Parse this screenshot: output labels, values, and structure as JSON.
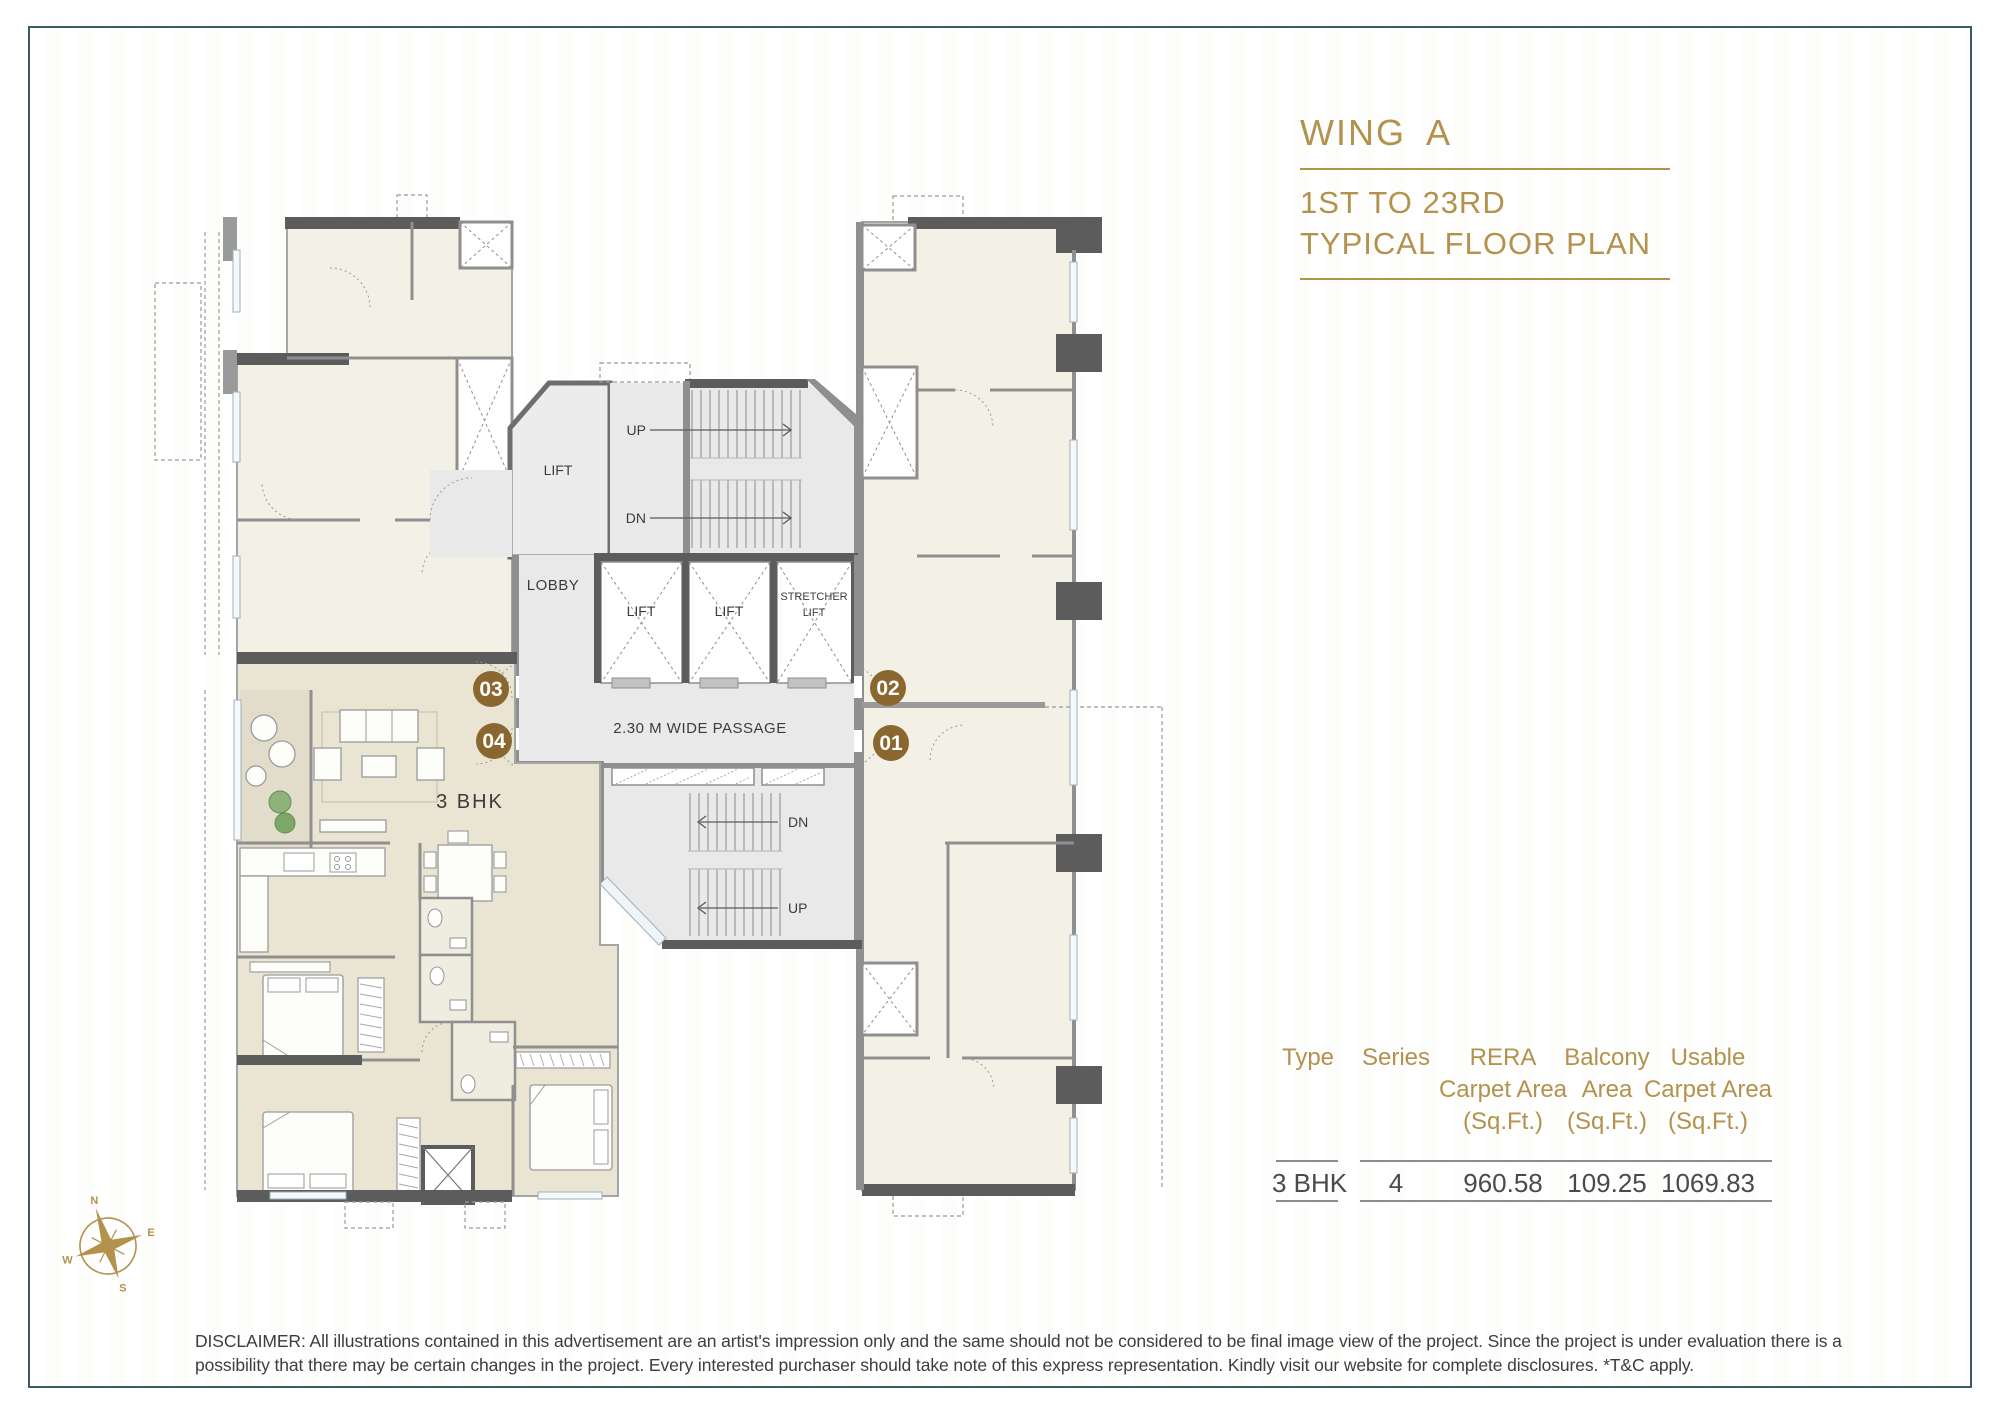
{
  "page": {
    "border_color": "#3e5a66",
    "accent_color": "#b2924d"
  },
  "header": {
    "wing_title": "WING A",
    "floor_line1": "1ST TO 23RD",
    "floor_line2": "TYPICAL FLOOR PLAN"
  },
  "floor_plan": {
    "labels": {
      "lift_room": "LIFT",
      "lobby": "LOBBY",
      "up_top": "UP",
      "dn_top": "DN",
      "lift_1": "LIFT",
      "lift_2": "LIFT",
      "stretcher_line1": "STRETCHER",
      "stretcher_line2": "LIFT",
      "passage": "2.30 M WIDE PASSAGE",
      "unit_type": "3 BHK",
      "dn_bottom": "DN",
      "up_bottom": "UP"
    },
    "unit_markers": [
      {
        "number": "03"
      },
      {
        "number": "04"
      },
      {
        "number": "02"
      },
      {
        "number": "01"
      }
    ],
    "marker_color": "#8a672f"
  },
  "compass": {
    "north": "N",
    "east": "E",
    "south": "S",
    "west": "W"
  },
  "area_table": {
    "columns": [
      {
        "line1": "Type",
        "line2": "",
        "line3": ""
      },
      {
        "line1": "Series",
        "line2": "",
        "line3": ""
      },
      {
        "line1": "RERA",
        "line2": "Carpet Area",
        "line3": "(Sq.Ft.)"
      },
      {
        "line1": "Balcony",
        "line2": "Area",
        "line3": "(Sq.Ft.)"
      },
      {
        "line1": "Usable",
        "line2": "Carpet Area",
        "line3": "(Sq.Ft.)"
      }
    ],
    "row": {
      "type": "3 BHK",
      "series": "4",
      "rera": "960.58",
      "balcony": "109.25",
      "usable": "1069.83"
    }
  },
  "disclaimer": "DISCLAIMER: All illustrations contained in this advertisement are an artist's impression only and the same should not be considered to be final image view of the project. Since the project is under evaluation there is a possibility that there may be certain changes in the project. Every interested purchaser should take note of this express representation. Kindly visit our website for complete disclosures. *T&C apply."
}
